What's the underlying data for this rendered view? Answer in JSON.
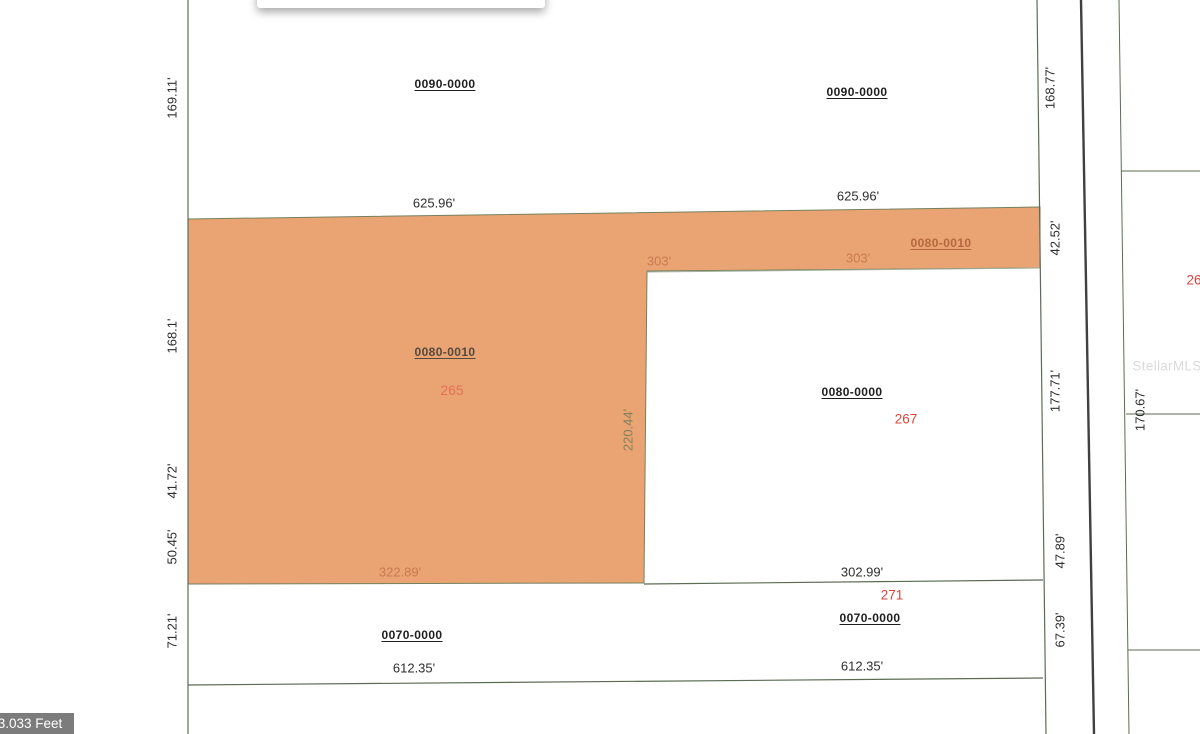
{
  "map": {
    "watermark": "StellarMLS",
    "scale_label": "3.033 Feet",
    "colors": {
      "highlight_parcel_fill": "#EAA473",
      "boundary_line": "#5c6b54",
      "road_line": "#404040",
      "lot_number_red": "#d9453c",
      "dimension_text": "#2e2e2e"
    },
    "tooltip": {
      "visible": true,
      "note": "empty tooltip cut off at top edge"
    },
    "parcels": [
      {
        "id": "0090-0000",
        "lot": "",
        "highlighted": false
      },
      {
        "id": "0080-0010",
        "lot": "265",
        "highlighted": true
      },
      {
        "id": "0080-0000",
        "lot": "267",
        "highlighted": false
      },
      {
        "id": "0070-0000",
        "lot": "271",
        "highlighted": false
      }
    ],
    "labels": [
      {
        "name": "dim-169-11",
        "text": "169.11'",
        "cls": "",
        "x": 172,
        "y": 98,
        "rot": -90
      },
      {
        "name": "parcel-id-0090-0000-left",
        "text": "0090-0000",
        "cls": "pid",
        "x": 445,
        "y": 84,
        "rot": 0
      },
      {
        "name": "parcel-id-0090-0000-right",
        "text": "0090-0000",
        "cls": "pid",
        "x": 857,
        "y": 92,
        "rot": 0
      },
      {
        "name": "dim-168-77",
        "text": "168.77'",
        "cls": "",
        "x": 1050,
        "y": 88,
        "rot": -90
      },
      {
        "name": "dim-625-96-left",
        "text": "625.96'",
        "cls": "",
        "x": 434,
        "y": 203,
        "rot": 0
      },
      {
        "name": "dim-625-96-right",
        "text": "625.96'",
        "cls": "",
        "x": 858,
        "y": 196,
        "rot": 0
      },
      {
        "name": "dim-42-52",
        "text": "42.52'",
        "cls": "",
        "x": 1055,
        "y": 238,
        "rot": -90
      },
      {
        "name": "dim-303-left",
        "text": "303'",
        "cls": "dim-orange",
        "x": 659,
        "y": 261,
        "rot": 0
      },
      {
        "name": "dim-303-right",
        "text": "303'",
        "cls": "dim-orange",
        "x": 858,
        "y": 258,
        "rot": 0
      },
      {
        "name": "parcel-id-0080-0010-strip",
        "text": "0080-0010",
        "cls": "pid pid-strip",
        "x": 941,
        "y": 243,
        "rot": 0
      },
      {
        "name": "dim-168-1",
        "text": "168.1'",
        "cls": "",
        "x": 172,
        "y": 336,
        "rot": -90
      },
      {
        "name": "parcel-id-0080-0010-main",
        "text": "0080-0010",
        "cls": "pid pid-main",
        "x": 445,
        "y": 352,
        "rot": 0
      },
      {
        "name": "lot-number-265",
        "text": "265",
        "cls": "salmon",
        "x": 452,
        "y": 390,
        "rot": 0
      },
      {
        "name": "parcel-id-0080-0000",
        "text": "0080-0000",
        "cls": "pid",
        "x": 852,
        "y": 392,
        "rot": 0
      },
      {
        "name": "lot-number-267",
        "text": "267",
        "cls": "red",
        "x": 906,
        "y": 419,
        "rot": 0
      },
      {
        "name": "dim-220-44",
        "text": "220.44'",
        "cls": "dim-olive",
        "x": 628,
        "y": 430,
        "rot": -90
      },
      {
        "name": "dim-177-71",
        "text": "177.71'",
        "cls": "",
        "x": 1055,
        "y": 391,
        "rot": -90
      },
      {
        "name": "dim-170-67",
        "text": "170.67'",
        "cls": "",
        "x": 1140,
        "y": 410,
        "rot": -90
      },
      {
        "name": "dim-41-72",
        "text": "41.72'",
        "cls": "",
        "x": 172,
        "y": 481,
        "rot": -90
      },
      {
        "name": "dim-50-45",
        "text": "50.45'",
        "cls": "",
        "x": 172,
        "y": 547,
        "rot": -90
      },
      {
        "name": "dim-47-89",
        "text": "47.89'",
        "cls": "",
        "x": 1060,
        "y": 551,
        "rot": -90
      },
      {
        "name": "dim-322-89",
        "text": "322.89'",
        "cls": "dim-orange",
        "x": 400,
        "y": 572,
        "rot": 0
      },
      {
        "name": "dim-302-99",
        "text": "302.99'",
        "cls": "",
        "x": 862,
        "y": 572,
        "rot": 0
      },
      {
        "name": "lot-number-271",
        "text": "271",
        "cls": "red",
        "x": 892,
        "y": 595,
        "rot": 0
      },
      {
        "name": "dim-67-39",
        "text": "67.39'",
        "cls": "",
        "x": 1060,
        "y": 630,
        "rot": -90
      },
      {
        "name": "dim-71-21",
        "text": "71.21'",
        "cls": "",
        "x": 172,
        "y": 631,
        "rot": -90
      },
      {
        "name": "parcel-id-0070-0000-left",
        "text": "0070-0000",
        "cls": "pid",
        "x": 412,
        "y": 635,
        "rot": 0
      },
      {
        "name": "parcel-id-0070-0000-right",
        "text": "0070-0000",
        "cls": "pid",
        "x": 870,
        "y": 618,
        "rot": 0
      },
      {
        "name": "dim-612-35-left",
        "text": "612.35'",
        "cls": "",
        "x": 414,
        "y": 668,
        "rot": 0
      },
      {
        "name": "dim-612-35-right",
        "text": "612.35'",
        "cls": "",
        "x": 862,
        "y": 666,
        "rot": 0
      },
      {
        "name": "lot-number-26-cutoff",
        "text": "26",
        "cls": "red",
        "x": 1194,
        "y": 280,
        "rot": 0
      },
      {
        "name": "stellar-mls-watermark",
        "text": "StellarMLS",
        "cls": "watermark",
        "x": 1167,
        "y": 366,
        "rot": 0
      }
    ]
  }
}
